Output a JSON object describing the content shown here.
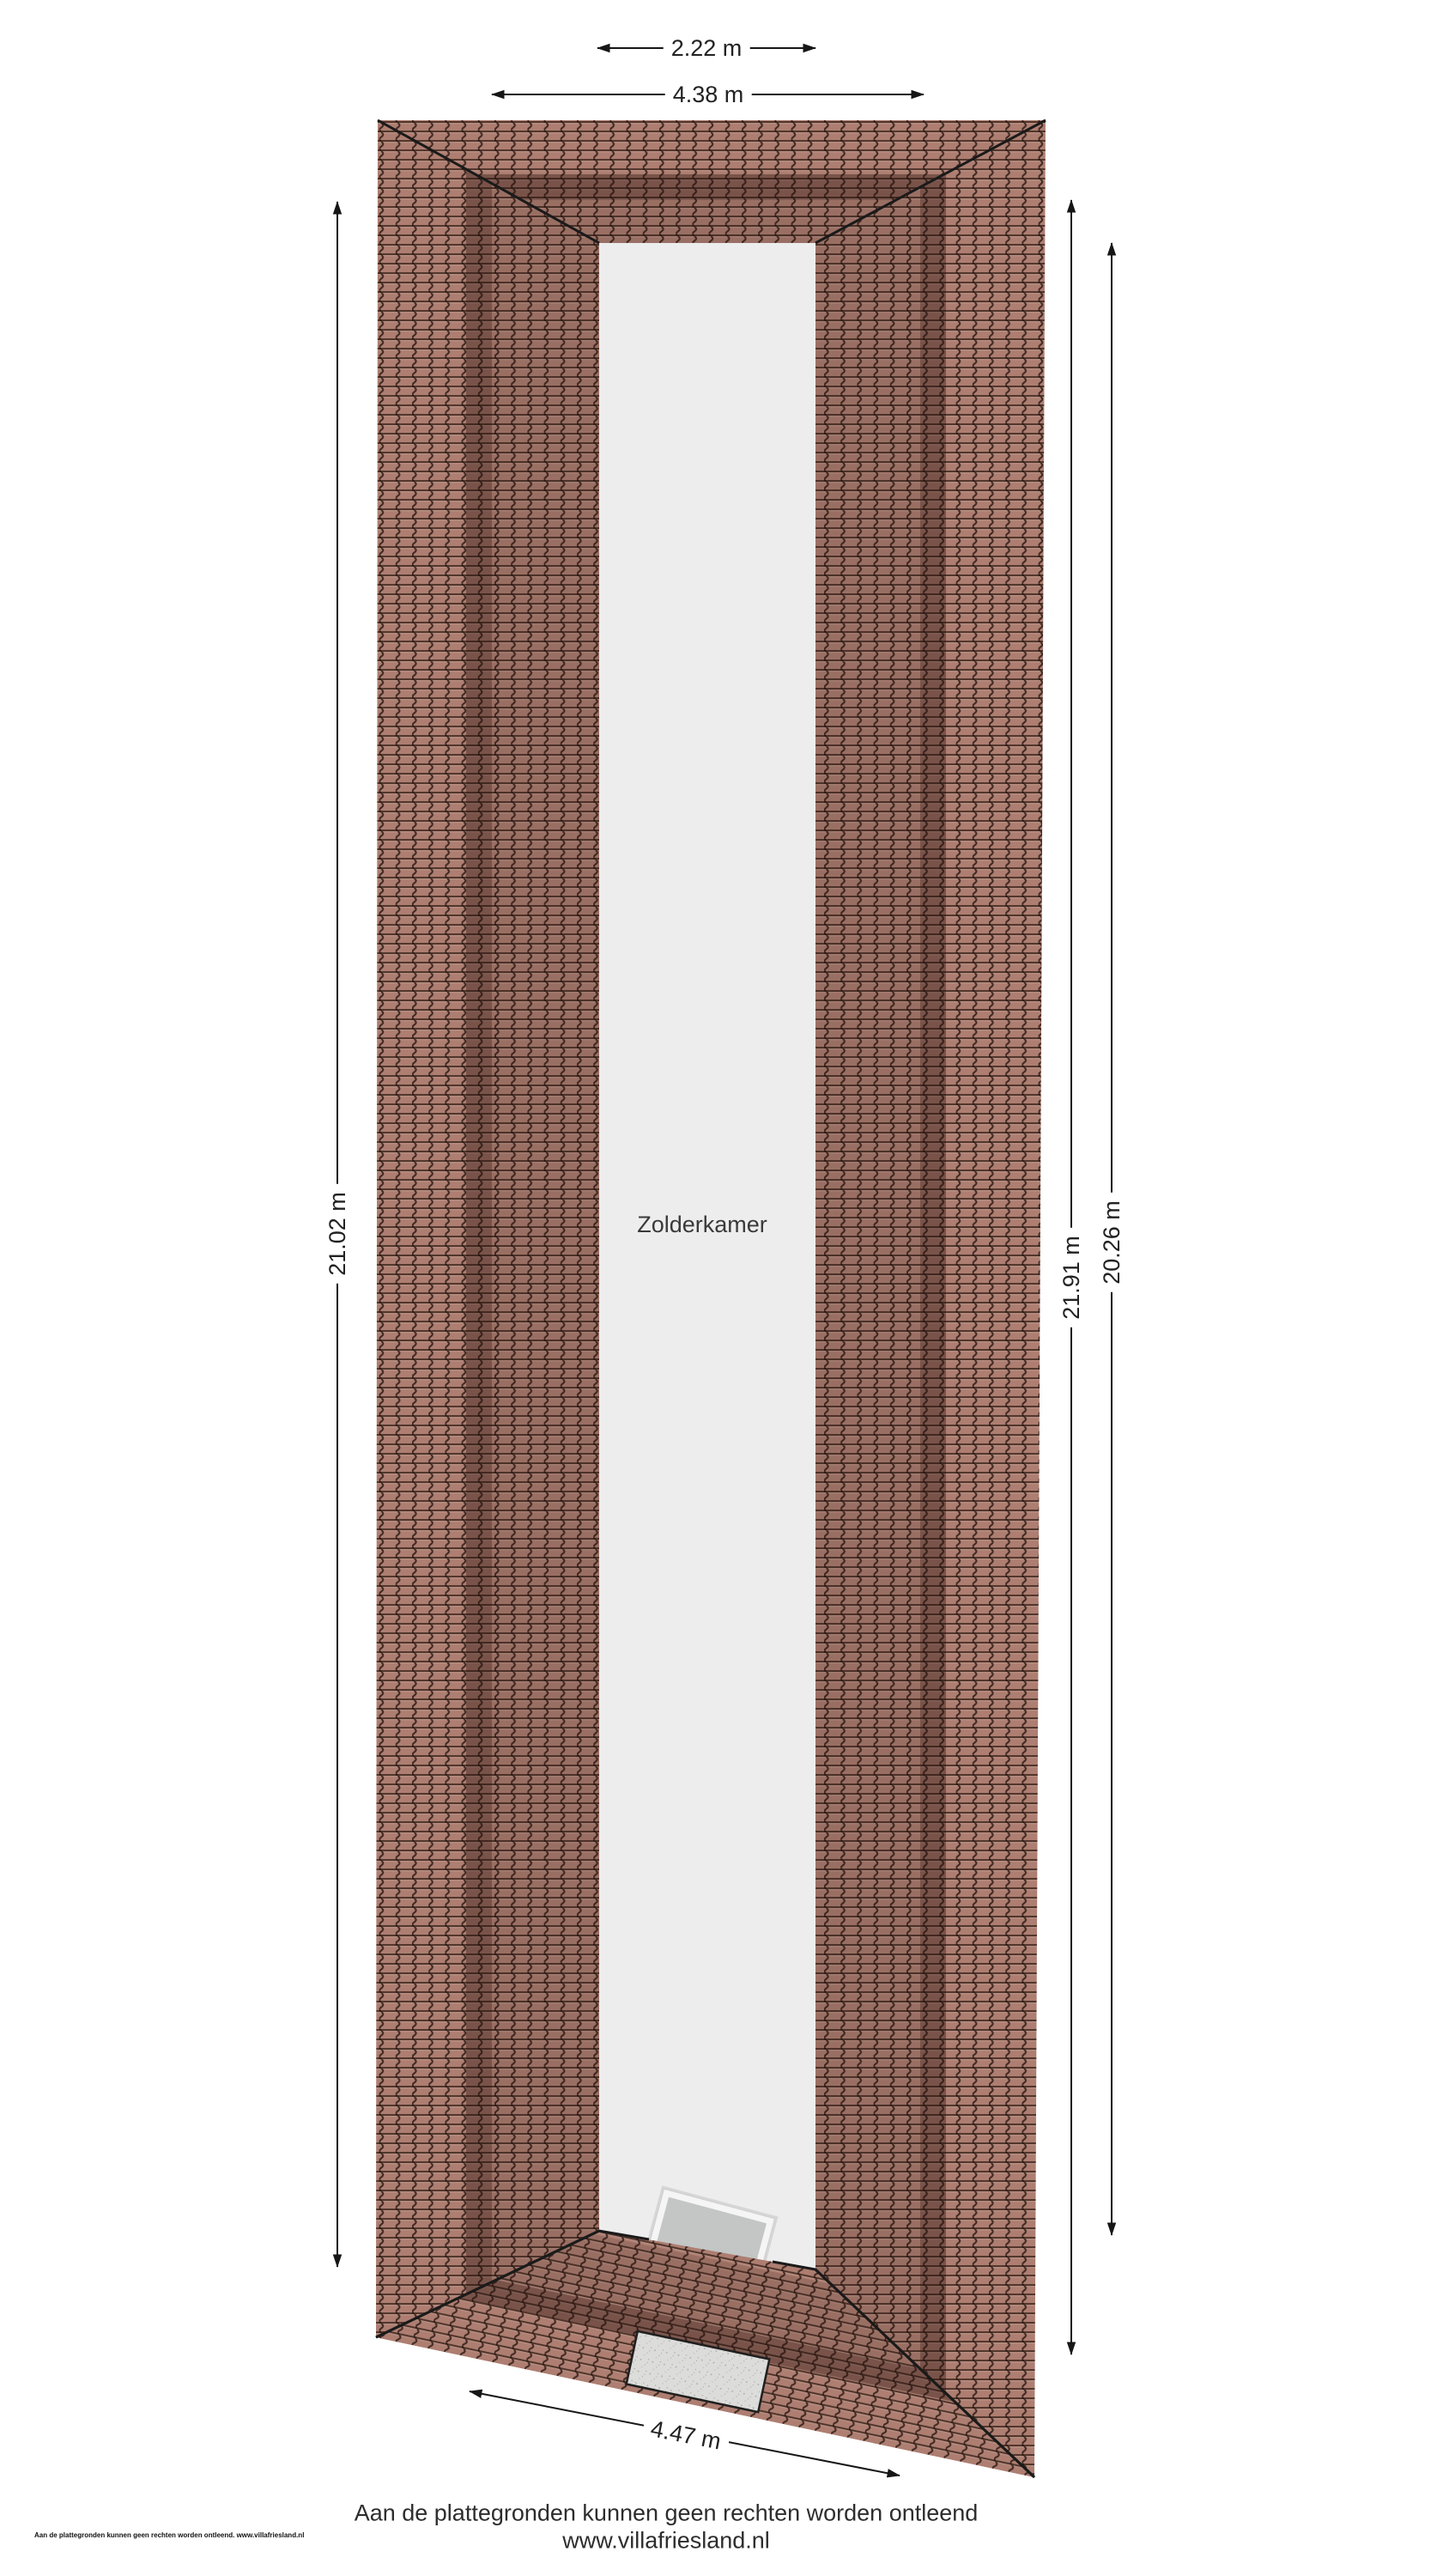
{
  "room": {
    "label": "Zolderkamer"
  },
  "dimensions": {
    "top_inner": "2.22 m",
    "top_outer": "4.38 m",
    "left": "21.02 m",
    "right_outer": "21.91 m",
    "right_inner": "20.26 m",
    "bottom": "4.47 m"
  },
  "footer": {
    "disclaimer": "Aan de plattegronden kunnen geen rechten worden ontleend",
    "website": "www.villafriesland.nl",
    "fineprint": "Aan de plattegronden kunnen geen rechten worden ontleend. www.villafriesland.nl"
  },
  "colors": {
    "background": "#ffffff",
    "tile_base": "#ad7e71",
    "tile_joint": "#4a332b",
    "roof_shadow_band": "rgba(43,21,15,0.40)",
    "roof_shadow_soft": "rgba(43,21,15,0.14)",
    "room_fill": "#ededed",
    "outline": "#1a1a1a",
    "chimney_fill": "#dcdcda",
    "skylight_frame": "#f5f5f5",
    "skylight_glass": "#c3c6c5",
    "dimension_line": "#161616"
  }
}
